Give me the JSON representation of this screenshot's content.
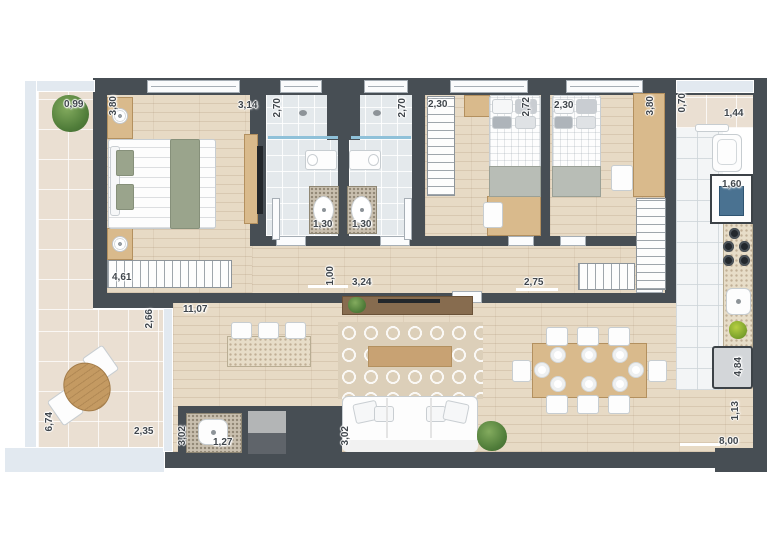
{
  "plan_type": "apartment-floor-plan-top-view",
  "palette": {
    "wall": "#474e54",
    "wood_floor": "#e7dac5",
    "terrace_tile": "#eadfd2",
    "bath_tile": "#e4e9ec",
    "kitchen_tile": "#f3f5f6",
    "furniture_wood": "#d9ba8c",
    "dark_wood": "#876c4f",
    "sage_textile": "#9aa48c",
    "plant_green": "#4f7c39",
    "washer_door_blue": "#4a7291",
    "glass": "#e2e9f0",
    "label_text": "#40464c"
  },
  "dims": {
    "balcony_width": "0,99",
    "bedroom1_depth": "3,80",
    "bedroom1_width": "3,14",
    "bath1_depth": "2,70",
    "bath1_width": "1,30",
    "bath2_depth": "2,70",
    "bath2_width": "1,30",
    "closet_hall": "2,30",
    "bedroom2_depth": "2,72",
    "bedroom3_width": "2,30",
    "bedroom3_depth": "3,80",
    "laundry_depth": "0,70",
    "laundry_width": "1,44",
    "washer_width": "1,60",
    "wardrobe_run": "4,61",
    "hall_width": "1,00",
    "hall_run": "3,24",
    "suite_opening": "2,75",
    "living_run": "11,07",
    "terrace_door": "2,66",
    "terrace_length": "6,74",
    "terrace_width": "2,35",
    "lavabo_depth": "3,02",
    "lavabo_sink": "1,27",
    "sofa_run": "3,02",
    "kitchen_run": "4,84",
    "kitchen_end": "1,13",
    "living_width": "8,00"
  }
}
